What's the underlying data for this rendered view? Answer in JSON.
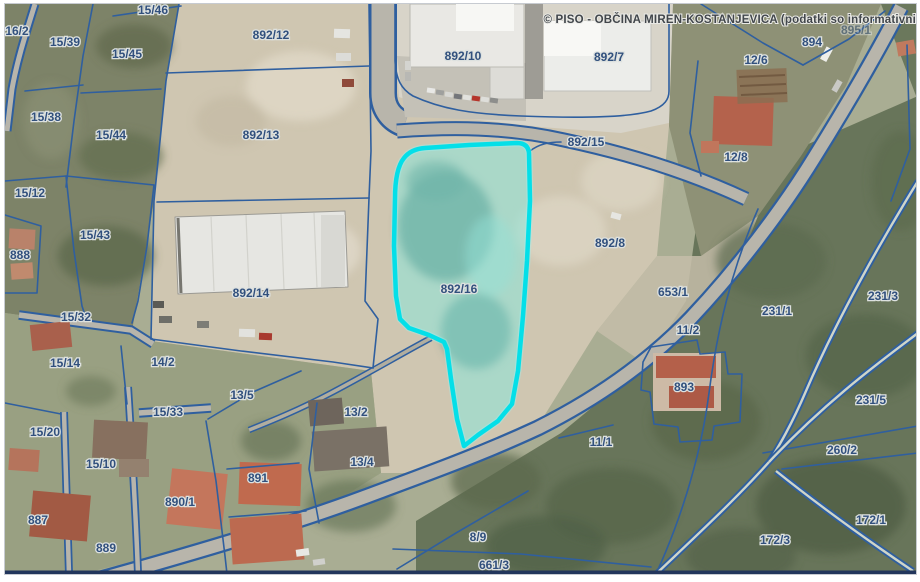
{
  "map": {
    "attribution": "© PISO - OBČINA MIREN-KOSTANJEVICA (podatki so informativni",
    "selected_parcel": "892/16",
    "colors": {
      "parcel_line": "#2f5f9f",
      "highlight_stroke": "#04dfe8",
      "highlight_fill": "#86e9df",
      "label_text": "#31507d",
      "attribution_text": "#41464b",
      "map_border_bottom": "#22365c"
    },
    "labels": [
      {
        "text": "16/2",
        "x": 16,
        "y": 34
      },
      {
        "text": "15/39",
        "x": 64,
        "y": 45
      },
      {
        "text": "15/45",
        "x": 126,
        "y": 57
      },
      {
        "text": "15/46",
        "x": 152,
        "y": 13
      },
      {
        "text": "15/38",
        "x": 45,
        "y": 120
      },
      {
        "text": "15/44",
        "x": 110,
        "y": 138
      },
      {
        "text": "15/12",
        "x": 29,
        "y": 196
      },
      {
        "text": "15/43",
        "x": 94,
        "y": 238
      },
      {
        "text": "888",
        "x": 19,
        "y": 258
      },
      {
        "text": "15/32",
        "x": 75,
        "y": 320
      },
      {
        "text": "15/14",
        "x": 64,
        "y": 366
      },
      {
        "text": "14/2",
        "x": 162,
        "y": 365
      },
      {
        "text": "13/5",
        "x": 241,
        "y": 398
      },
      {
        "text": "15/33",
        "x": 167,
        "y": 415
      },
      {
        "text": "15/20",
        "x": 44,
        "y": 435
      },
      {
        "text": "13/2",
        "x": 355,
        "y": 415
      },
      {
        "text": "15/10",
        "x": 100,
        "y": 467
      },
      {
        "text": "13/4",
        "x": 361,
        "y": 465
      },
      {
        "text": "891",
        "x": 257,
        "y": 481
      },
      {
        "text": "890/1",
        "x": 179,
        "y": 505
      },
      {
        "text": "887",
        "x": 37,
        "y": 523
      },
      {
        "text": "889",
        "x": 105,
        "y": 551
      },
      {
        "text": "892/12",
        "x": 270,
        "y": 38
      },
      {
        "text": "892/13",
        "x": 260,
        "y": 138
      },
      {
        "text": "892/14",
        "x": 250,
        "y": 296
      },
      {
        "text": "892/16",
        "x": 458,
        "y": 292
      },
      {
        "text": "892/10",
        "x": 462,
        "y": 59
      },
      {
        "text": "892/7",
        "x": 608,
        "y": 60
      },
      {
        "text": "892/15",
        "x": 585,
        "y": 145
      },
      {
        "text": "892/8",
        "x": 609,
        "y": 246
      },
      {
        "text": "653/1",
        "x": 672,
        "y": 295
      },
      {
        "text": "11/2",
        "x": 687,
        "y": 333
      },
      {
        "text": "893",
        "x": 683,
        "y": 390
      },
      {
        "text": "11/1",
        "x": 600,
        "y": 445
      },
      {
        "text": "8/9",
        "x": 477,
        "y": 540
      },
      {
        "text": "661/3",
        "x": 493,
        "y": 568
      },
      {
        "text": "894",
        "x": 811,
        "y": 45
      },
      {
        "text": "12/6",
        "x": 755,
        "y": 63
      },
      {
        "text": "12/8",
        "x": 735,
        "y": 160
      },
      {
        "text": "231/1",
        "x": 776,
        "y": 314
      },
      {
        "text": "231/3",
        "x": 882,
        "y": 299
      },
      {
        "text": "231/5",
        "x": 870,
        "y": 403
      },
      {
        "text": "260/2",
        "x": 841,
        "y": 453
      },
      {
        "text": "172/1",
        "x": 870,
        "y": 523
      },
      {
        "text": "172/3",
        "x": 774,
        "y": 543
      },
      {
        "text": "895/1",
        "x": 855,
        "y": 33,
        "faint": true
      }
    ]
  }
}
